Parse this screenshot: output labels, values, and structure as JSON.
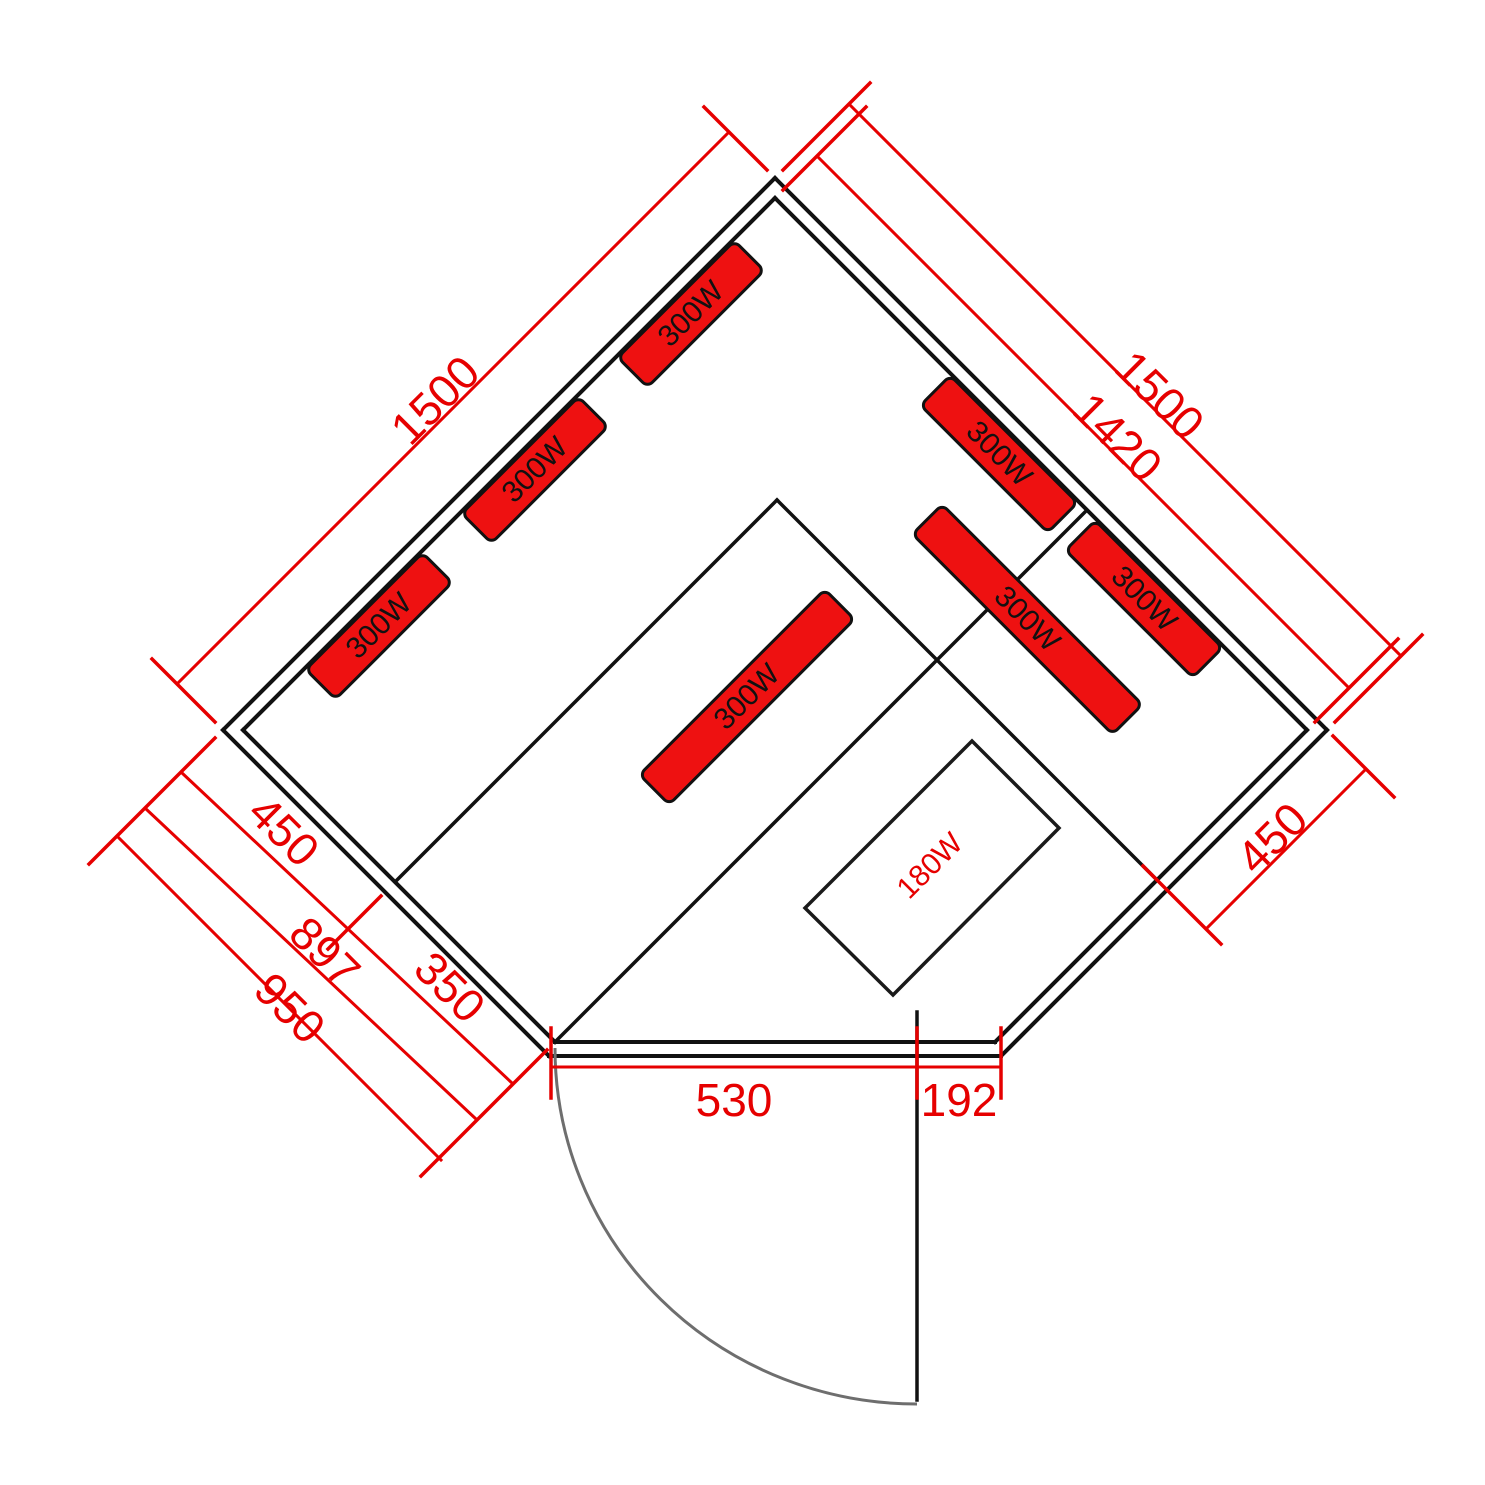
{
  "drawing_type": "sauna-floor-plan",
  "colors": {
    "dimension_red": "#e60000",
    "heater_fill": "#ee1111",
    "wall_black": "#111111",
    "door_arc_gray": "#6e6e6e",
    "background": "#ffffff"
  },
  "dims": {
    "wall_left_outer": "1500",
    "wall_right_outer": "1500",
    "wall_right_inner": "1420",
    "bench_left_depth": "450",
    "step_left": "350",
    "side_left_inner": "897",
    "side_left_outer": "950",
    "side_right_bench": "450",
    "door_opening": "530",
    "door_side_panel": "192"
  },
  "heaters": [
    {
      "label": "300W"
    },
    {
      "label": "300W"
    },
    {
      "label": "300W"
    },
    {
      "label": "300W"
    },
    {
      "label": "300W"
    },
    {
      "label": "300W"
    },
    {
      "label": "300W"
    }
  ],
  "floor_heater": {
    "label": "180W"
  }
}
